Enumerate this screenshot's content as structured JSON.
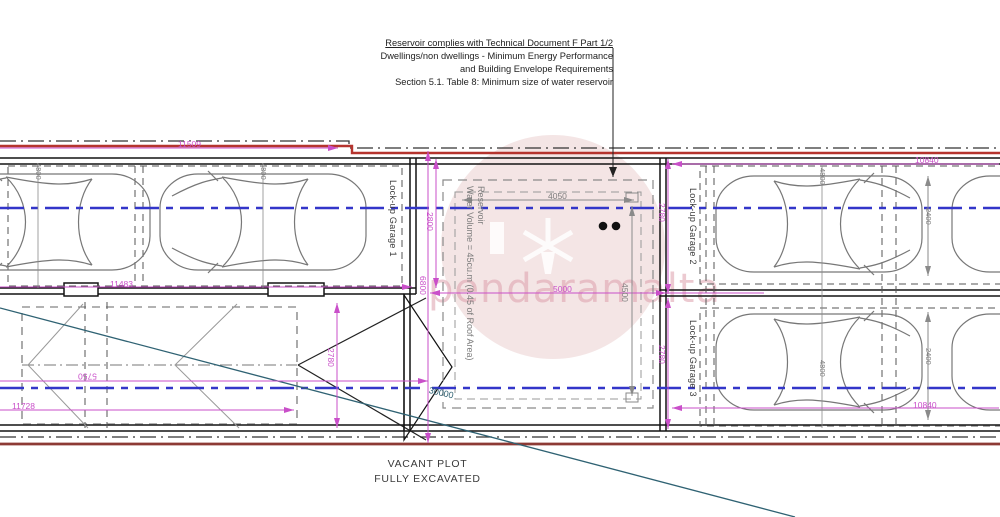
{
  "annotation": {
    "line1": "Reservoir complies with Technical Document F Part 1/2",
    "line2": "Dwellings/non dwellings - Minimum Energy Performance",
    "line3": "and Building Envelope Requirements",
    "line4": "Section 5.1. Table 8: Minimum size of water reservoir"
  },
  "garages": {
    "garage1": "Lock-up Garage 1",
    "garage2": "Lock-up Garage 2",
    "garage3": "Lock-up Garage 3"
  },
  "reservoir": {
    "title": "Reservoir",
    "volume": "Water Volume = 45cu.m (0.45 of Roof Area)"
  },
  "plot": {
    "line1": "VACANT PLOT",
    "line2": "FULLY EXCAVATED"
  },
  "watermark": {
    "text": "pendaramalta"
  },
  "dims": {
    "top_left_width": "11509",
    "garage1_inner_width": "11483",
    "plot_part_width": "5750",
    "plot_width": "11728",
    "plot_depth": "2780",
    "garage1_depth": "2800",
    "site_depth": "6800",
    "mid_width": "5000",
    "reservoir_width": "4050",
    "reservoir_depth": "4500",
    "garage2_depth": "2780",
    "garage3_depth": "2780",
    "right_width_top": "10840",
    "right_width_bottom": "10840",
    "car_length_a": "4800",
    "car_length_b": "4800",
    "car_length_c": "4800",
    "car_length_d": "4800",
    "car_width_a": "2400",
    "car_width_b": "2400",
    "diagonal_length": "30000"
  },
  "colors": {
    "dimension_magenta": "#c94fc9",
    "centerline_blue": "#3336c9",
    "boundary_red": "#b5342e",
    "boundary_dark_red": "#8d3a35",
    "diagonal_teal": "#2f6273"
  }
}
